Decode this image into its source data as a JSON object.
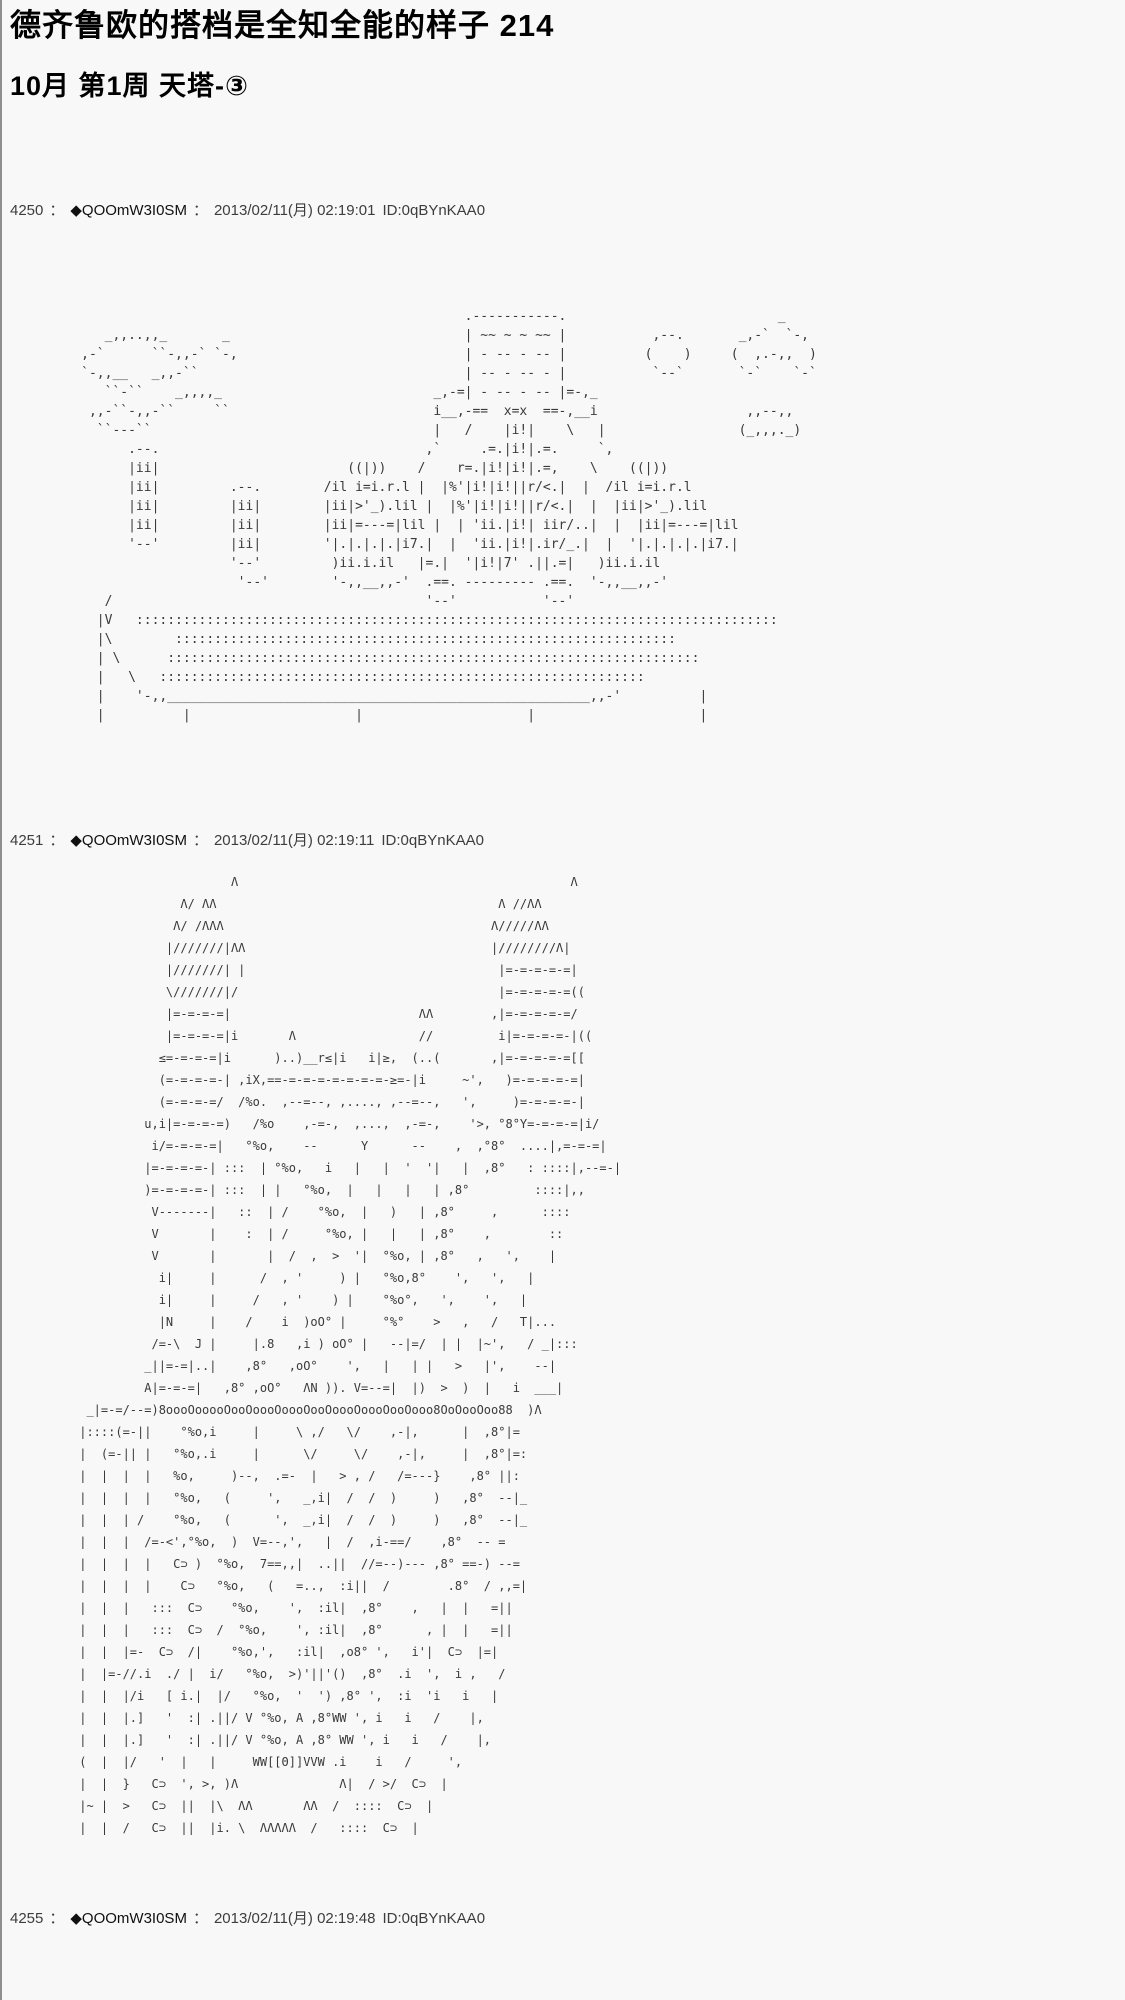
{
  "page": {
    "title": "德齐鲁欧的搭档是全知全能的样子  214",
    "subtitle": "10月  第1周  天塔-③",
    "background_color": "#f8f8f8",
    "text_color": "#111111",
    "header_text_color": "#3d3d3d"
  },
  "posts": [
    {
      "number": "4250",
      "sep": "：",
      "tripcode": "◆QOOmW3I0SM",
      "datetime": "2013/02/11(月) 02:19:01",
      "id": "ID:0qBYnKAA0",
      "aa": [
        "                                                      .-----------.                           _",
        "        _,,..,,_       _                              | ~~ ~ ~ ~~ |           ,--.       _,-`  `-,",
        "     ,-`      ``-,,-` `-,                             | - -- - -- |          (    )     (  ,.-,,  )",
        "     `-,,__   _,,-``                                  | -- - -- - |           `--`       `-`    `-`",
        "        ``-``    _,,,,_                           _,-=| - -- - -- |=-,_",
        "      ,,-``-,,-``     ``                          i__,-==  x=x  ==-,__i                   ,,--,,",
        "       ``---``                                    |   /    |i!|    \\   |                 (_,,,._)",
        "           .--.                                  ,`     .=.|i!|.=.     `,",
        "           |ii|                        ((|))    /    r=.|i!|i!|.=,    \\    ((|))",
        "           |ii|         .--.        /il i=i.r.l |  |%'|i!|i!||r/<.|  |  /il i=i.r.l",
        "           |ii|         |ii|        |ii|>'_).lil |  |%'|i!|i!||r/<.|  |  |ii|>'_).lil",
        "           |ii|         |ii|        |ii|=---=|lil |  | 'ii.|i!| iir/..|  |  |ii|=---=|lil",
        "           '--'         |ii|        '|.|.|.|.|i7.|  |  'ii.|i!|.ir/_.|  |  '|.|.|.|.|i7.|",
        "                        '--'         )ii.i.il   |=.|  '|i!|7' .||.=|   )ii.i.il",
        "                         '--'        '-,,__,,-'  .==. --------- .==.  '-,,__,,-'",
        "        /                                        '--'           '--'",
        "       |V   ::::::::::::::::::::::::::::::::::::::::::::::::::::::::::::::::::::::::::::::::::",
        "       |\\        ::::::::::::::::::::::::::::::::::::::::::::::::::::::::::::::::",
        "       | \\      ::::::::::::::::::::::::::::::::::::::::::::::::::::::::::::::::::::",
        "       |   \\   ::::::::::::::::::::::::::::::::::::::::::::::::::::::::::::::",
        "       |    '-,,______________________________________________________,,-'          |",
        "       |          |                     |                     |                     |"
      ]
    },
    {
      "number": "4251",
      "sep": "：",
      "tripcode": "◆QOOmW3I0SM",
      "datetime": "2013/02/11(月) 02:19:11",
      "id": "ID:0qBYnKAA0",
      "aa": [
        "                      Λ                                              Λ",
        "               Λ/ ΛΛ                                       Λ //ΛΛ",
        "              Λ/ /ΛΛΛ                                     Λ/////ΛΛ",
        "             |///////|ΛΛ                                  |////////Λ|",
        "             |///////| |                                   |=-=-=-=-=|",
        "             \\///////|/                                    |=-=-=-=-=((",
        "             |=-=-=-=|                          ΛΛ        ,|=-=-=-=-=/",
        "             |=-=-=-=|i       Λ                 //         i|=-=-=-=-|((",
        "            ≤=-=-=-=|i      )..)__r≤|i   i|≥,  (..(       ,|=-=-=-=-=[[",
        "            (=-=-=-=-| ,iX,==-=-=-=-=-=-=-=-≥=-|i     ~',   )=-=-=-=-=|",
        "            (=-=-=-=/  /%o.  ,--=--, ,...., ,--=--,   ',     )=-=-=-=-|",
        "          u,i|=-=-=-=)   /%o    ,-=-,  ,...,  ,-=-,    '>, °8°Y=-=-=-=|i/",
        "           i/=-=-=-=|   °%o,    --      Y      --    ,  ,°8°  ....|,=-=-=|",
        "          |=-=-=-=-| :::  | °%o,   i   |   |  '  '|   |  ,8°   : ::::|,--=-|",
        "          )=-=-=-=-| :::  | |   °%o,  |   |   |   | ,8°         ::::|,,",
        "           V-------|   ::  | /    °%o,  |   )   | ,8°     ,      ::::",
        "           V       |    :  | /     °%o, |   |   | ,8°    ,        ::",
        "           V       |       |  /  ,  >  '|  °%o, | ,8°   ,   ',    |",
        "            i|     |      /  , '     ) |   °%o,8°    ',   ',   |",
        "            i|     |     /   , '    ) |    °%o°,   ',    ',   |",
        "            |N     |    /    i  )oO° |     °%°    >   ,   /   T|...",
        "           /=-\\  J |     |.8   ,i ) oO° |   --|=/  | |  |~',   / _|:::",
        "          _||=-=|..|    ,8°   ,oO°    ',   |   | |   >   |',    --|",
        "          A|=-=-=|   ,8° ,oO°   ΛN )). V=--=|  |)  >  )  |   i  ___|",
        "  _|=-=/--=)8oooOooooOooOoooOoooOooOoooOoooOooOooo8OoOooOoo88  )Λ",
        " |::::(=-||    °%o,i     |     \\ ,/   \\/    ,-|,      |  ,8°|=",
        " |  (=-|| |   °%o,.i     |      \\/     \\/    ,-|,     |  ,8°|=:",
        " |  |  |  |   %o,     )--,  .=-  |   > , /   /=---}    ,8° ||:",
        " |  |  |  |   °%o,   (     ',   _,i|  /  /  )     )   ,8°  --|_",
        " |  |  | /    °%o,   (      ',  _,i|  /  /  )     )   ,8°  --|_",
        " |  |  |  /=-<',°%o,  )  V=--,',   |  /  ,i-==/    ,8°  -- =",
        " |  |  |  |   C⊃ )  °%o,  7==,,|  ..||  //=--)--- ,8° ==-) --=",
        " |  |  |  |    C⊃   °%o,   (   =..,  :i||  /        .8°  / ,,=|",
        " |  |  |   :::  C⊃    °%o,    ',  :il|  ,8°    ,   |  |   =||",
        " |  |  |   :::  C⊃  /  °%o,    ', :il|  ,8°      , |  |   =||",
        " |  |  |=-  C⊃  /|    °%o,',   :il|  ,o8° ',   i'|  C⊃  |=|",
        " |  |=-//.i  ./ |  i/   °%o,  >)'||'()  ,8°  .i  ',  i ,   /",
        " |  |  |/i   [ i.|  |/   °%o,  '  ') ,8° ',  :i  'i   i   |",
        " |  |  |.]   '  :| .||/ V °%o, A ,8°WW ', i   i   /    |,",
        " |  |  |.]   '  :| .||/ V °%o, A ,8° WW ', i   i   /    |,",
        " (  |  |/   '  |   |     WW[[Θ]]VVW .i    i   /     ',",
        " |  |  }   C⊃  ', >, )Λ              Λ|  / >/  C⊃  |",
        " |~ |  >   C⊃  ||  |\\  ΛΛ       ΛΛ  /  ::::  C⊃  |",
        " |  |  /   C⊃  ||  |i. \\  ΛΛΛΛΛ  /   ::::  C⊃  |"
      ]
    },
    {
      "number": "4255",
      "sep": "：",
      "tripcode": "◆QOOmW3I0SM",
      "datetime": "2013/02/11(月) 02:19:48",
      "id": "ID:0qBYnKAA0",
      "aa": []
    }
  ]
}
